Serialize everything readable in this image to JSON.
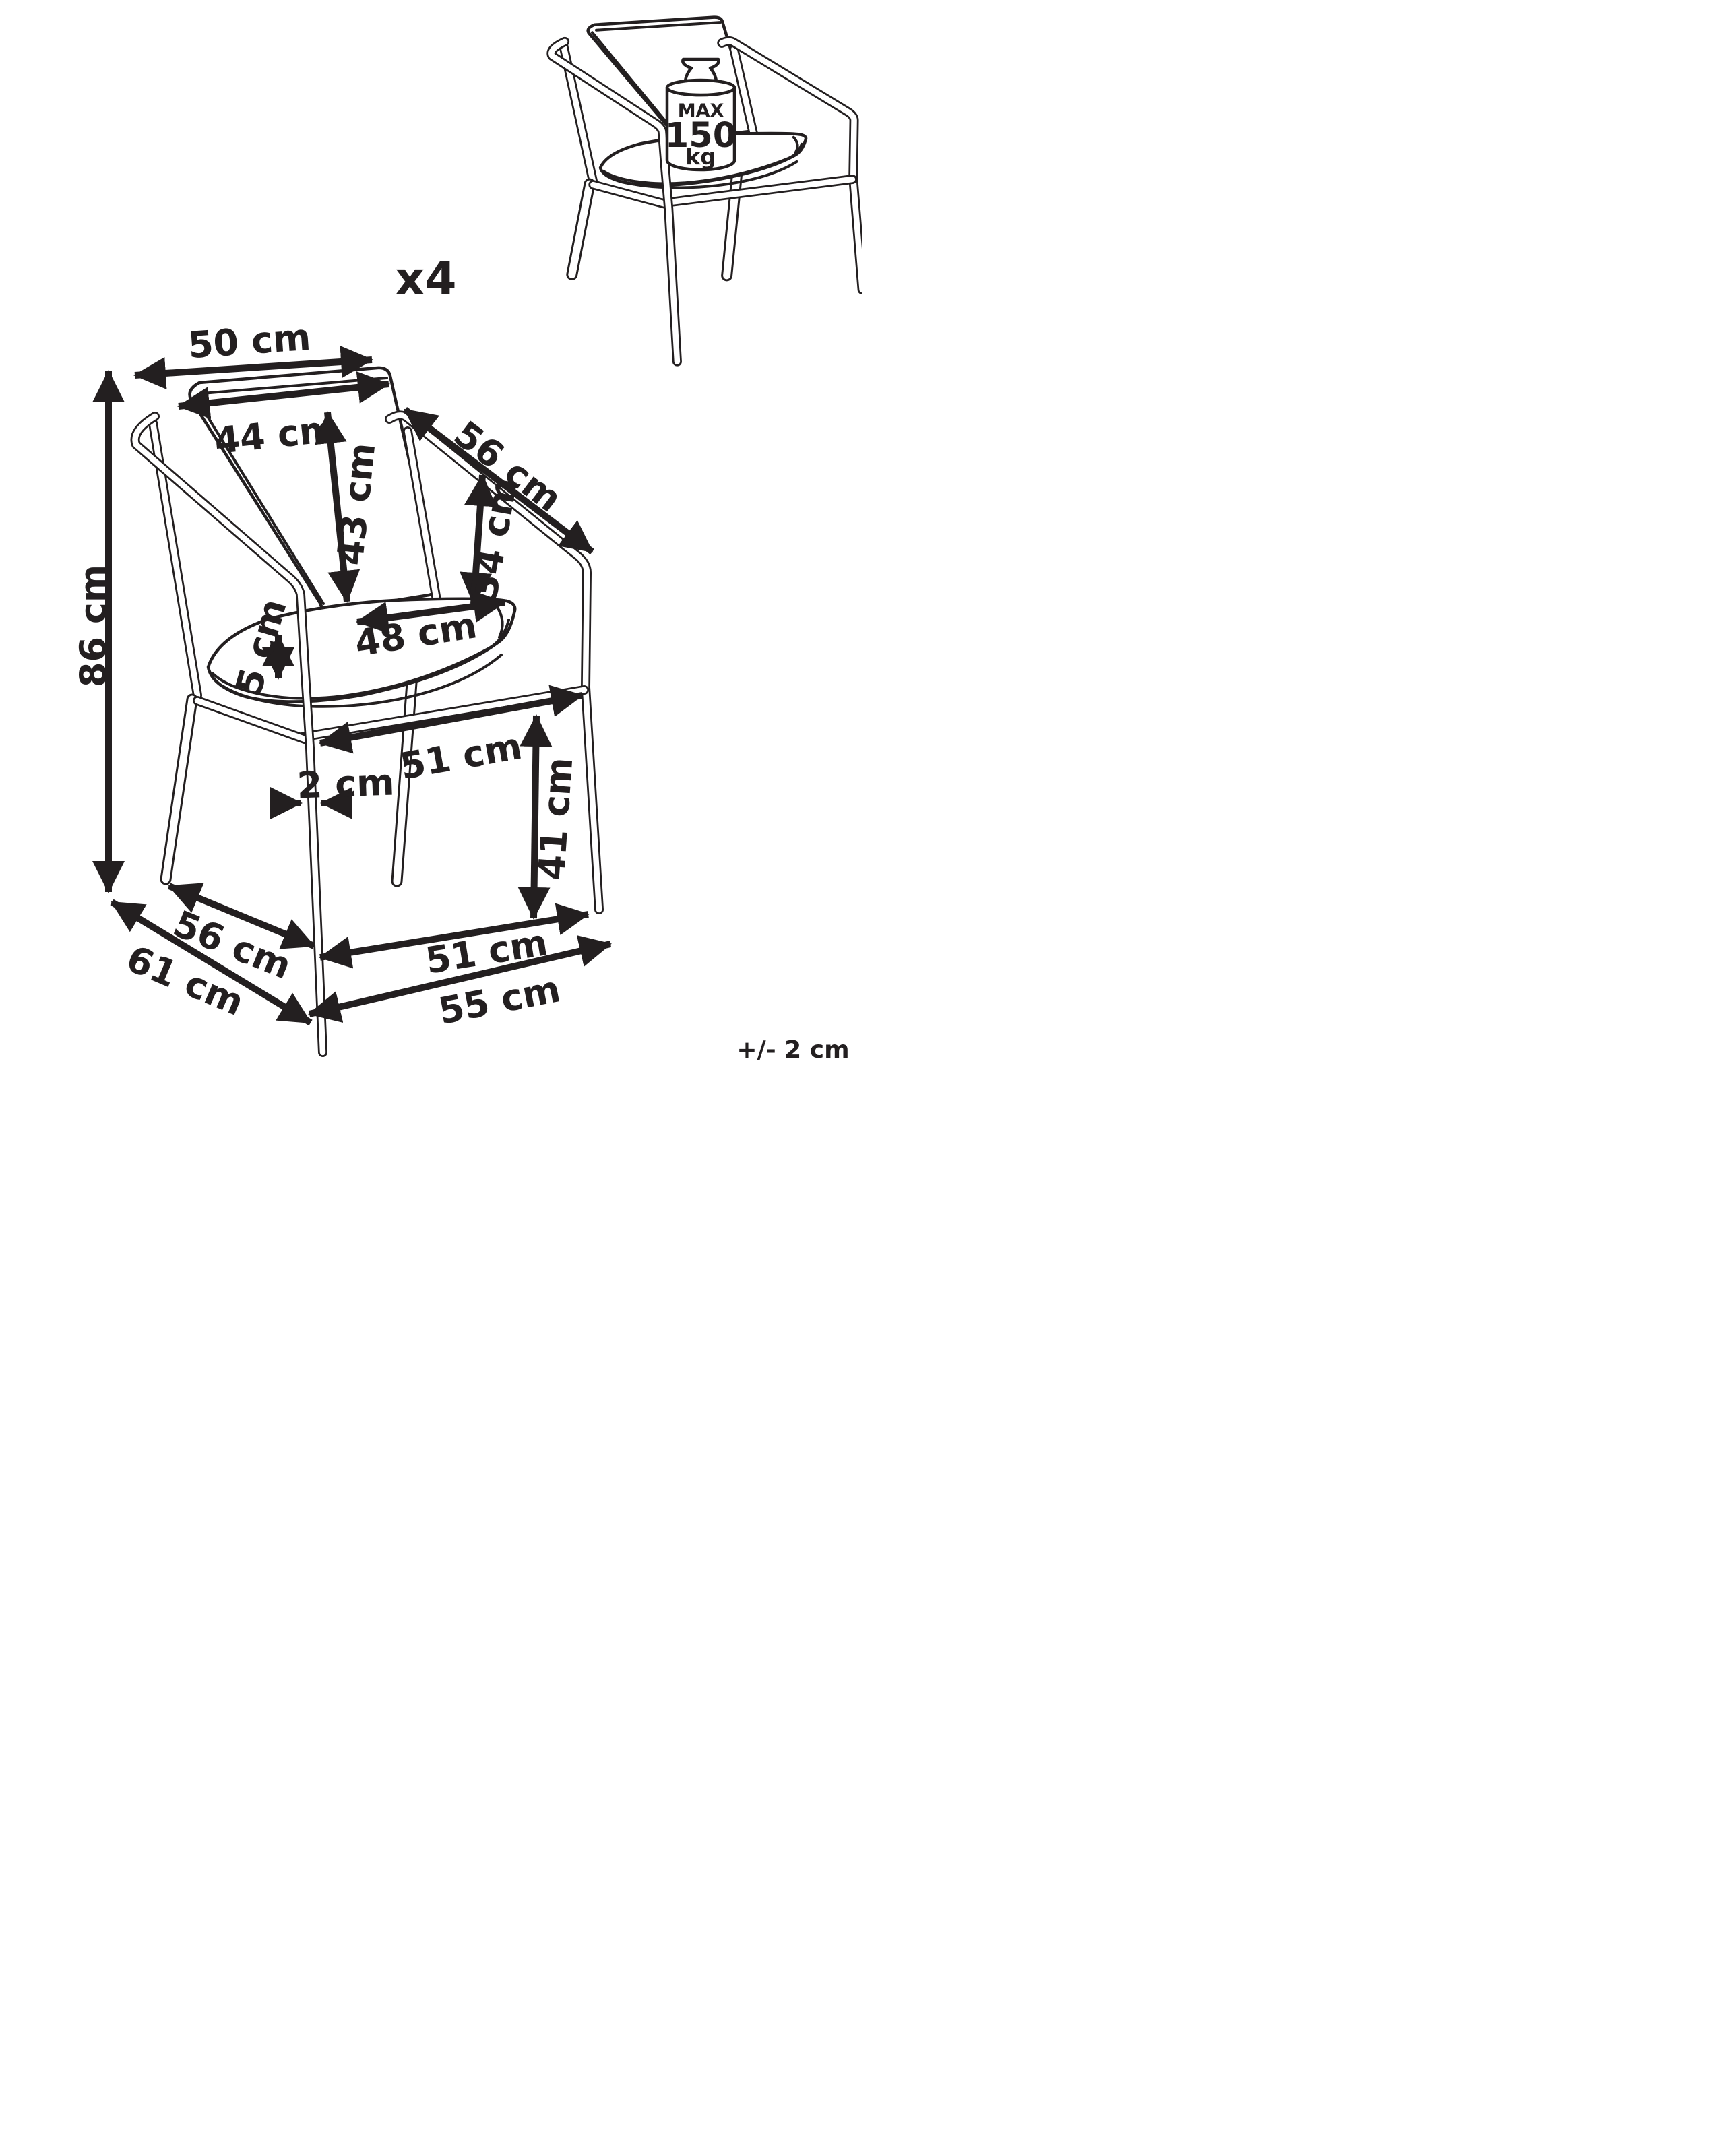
{
  "figure": {
    "quantity": "x4",
    "tolerance_note": "+/- 2 cm"
  },
  "weight_capacity": {
    "line1": "MAX",
    "line2": "150",
    "line3": "kg"
  },
  "dimensions": {
    "back_frame_width": "50 cm",
    "backrest_cushion_width": "44 cm",
    "backrest_cushion_height": "43 cm",
    "armrest_length": "56 cm",
    "backrest_height_above_seat": "34 cm",
    "seat_cushion_width": "48 cm",
    "seat_cushion_thickness": "5 cm",
    "total_height": "86 cm",
    "seat_frame_width": "51 cm",
    "leg_thickness": "2 cm",
    "seat_height": "41 cm",
    "seat_depth": "56 cm",
    "total_depth": "61 cm",
    "front_frame_width": "51 cm",
    "total_width": "55 cm"
  }
}
